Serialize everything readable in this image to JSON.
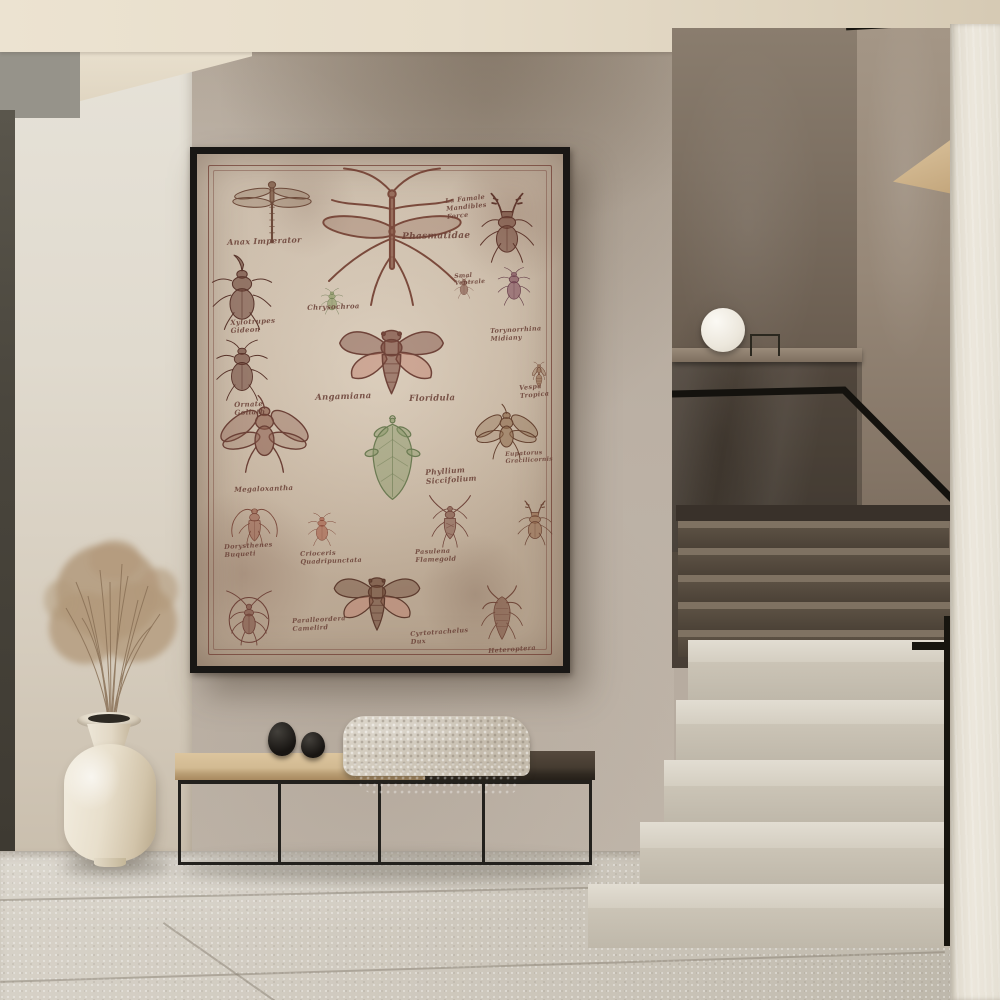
{
  "scene": {
    "type": "interior-photo",
    "description": "Minimal hallway with framed vintage entomology poster over a bench, dried pampas grass in a cream vase, and a terrazzo staircase with black handrail"
  },
  "poster": {
    "labels": [
      {
        "id": "anax-imperator",
        "text": "Anax Imperator"
      },
      {
        "id": "phasmatidae",
        "text": "Phasmatidae"
      },
      {
        "id": "mandibles-note",
        "text": "La Famale\nMandibles\nForce"
      },
      {
        "id": "xylotrupes",
        "text": "Xylotrupes\nGideon"
      },
      {
        "id": "chrysochroa",
        "text": "Chrysochroa"
      },
      {
        "id": "ventrale-note",
        "text": "Smal\nVentrale"
      },
      {
        "id": "torynorrhina",
        "text": "Torynorrhina\nMidiany"
      },
      {
        "id": "ornate-goliath",
        "text": "Ornate\nGoliath"
      },
      {
        "id": "angamiana",
        "text": "Angamiana"
      },
      {
        "id": "floridula",
        "text": "Floridula"
      },
      {
        "id": "vespa-tropica",
        "text": "Vespa\nTropica"
      },
      {
        "id": "megaloxantha",
        "text": "Megaloxantha"
      },
      {
        "id": "phyllium",
        "text": "Phyllium\nSiccifolium"
      },
      {
        "id": "eupatorus",
        "text": "Eupatorus\nGracilicornis"
      },
      {
        "id": "dorysthenes",
        "text": "Dorysthenes\nBuqueti"
      },
      {
        "id": "crioceris",
        "text": "Crioceris\nQuadripunctata"
      },
      {
        "id": "pasulena",
        "text": "Pasulena\nFlamegold"
      },
      {
        "id": "paralleordera",
        "text": "Paralleordera\nCamelird"
      },
      {
        "id": "cyrtotrachelus",
        "text": "Cyrtotrachelus\nDux"
      },
      {
        "id": "heteroptera",
        "text": "Heteroptera"
      }
    ]
  },
  "objects": {
    "poster": "framed-entomology-chart",
    "bench": "metal-frame-bench",
    "blanket": "waffle-knit-throw",
    "stones": "two-black-decor-stones",
    "vase": "cream-ceramic-vase",
    "plant": "dried-pampas-grass",
    "lamp": "white-sphere-lamp",
    "stairs": "terrazzo-staircase"
  },
  "palette": {
    "wall": "#b7aca0",
    "wall_light": "#ddd8cc",
    "ceiling": "#e8dfcd",
    "dark_panel": "#4b463c",
    "frame": "#191715",
    "paper": "#c4b4a2",
    "ink": "#6f4339",
    "ink_green": "#7e8f63",
    "ink_pink": "#c2897a",
    "bench_wood": "#d2ba92",
    "bench_dark": "#40382f",
    "metal": "#23211d",
    "blanket": "#d1c9bc",
    "vase": "#ece3d2",
    "grass": "#b0977a",
    "stair_light": "#d8d3c8",
    "stair_dark": "#6b5f52",
    "stair_wall": "#6e6257",
    "rail": "#17150f",
    "floor": "#cfc9be",
    "right_wall": "#eae5da",
    "lamp": "#f6f3ec"
  }
}
